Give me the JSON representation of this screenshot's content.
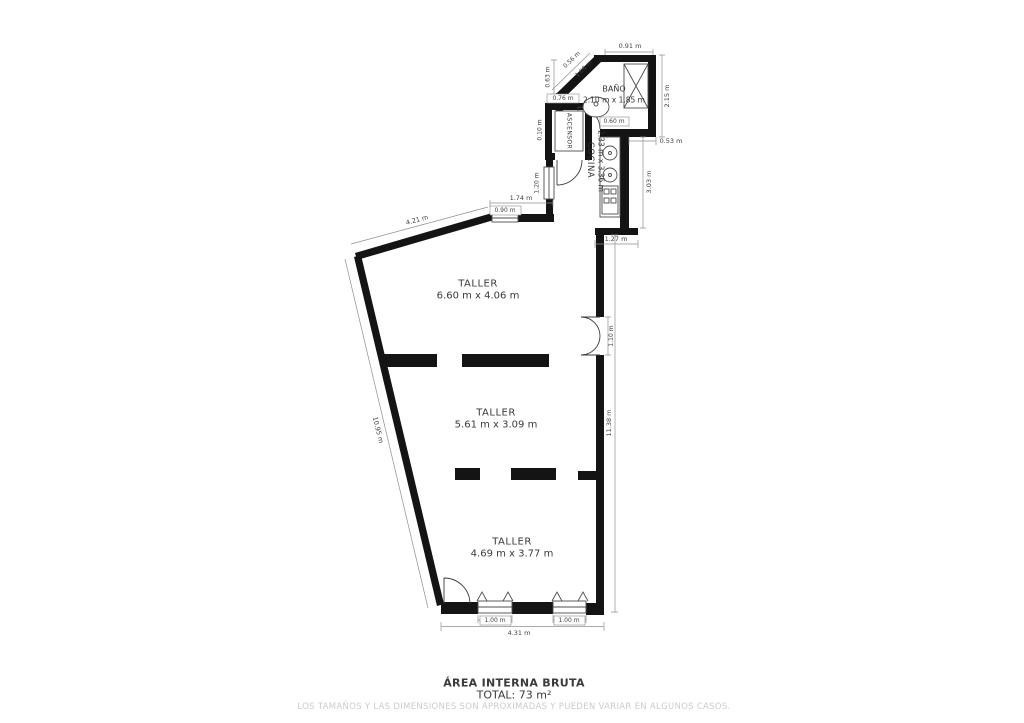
{
  "plan": {
    "rooms": {
      "bano": {
        "name": "BAÑO",
        "size": "2.10 m x 1.85 m"
      },
      "cocina": {
        "name": "COCINA",
        "size": "2.33 m x 3.36 m"
      },
      "ascensor": {
        "name": "ASCENSOR"
      },
      "taller_top": {
        "name": "TALLER",
        "size": "6.60 m x 4.06 m"
      },
      "taller_mid": {
        "name": "TALLER",
        "size": "5.61 m x 3.09 m"
      },
      "taller_bot": {
        "name": "TALLER",
        "size": "4.69 m x 3.77 m"
      }
    },
    "dimensions": {
      "bano_width_top": "0.91 m",
      "chamfer_outer": "0.56 m",
      "chamfer_inner": "1.09 m",
      "bano_left": "0.63 m",
      "bano_right": "2.15 m",
      "bano_door": "0.60 m",
      "bano_offset": "0.53 m",
      "ascensor_width": "0.76 m",
      "wall_gap": "0.10 m",
      "corridor_window": "1.20 m",
      "cocina_right": "3.03 m",
      "cocina_bottom": "1.27 m",
      "top_span": "1.74 m",
      "top_window": "0.90 m",
      "top_wall": "4.21 m",
      "left_wall": "10.95 m",
      "right_wall": "11.38 m",
      "double_door": "1.10 m",
      "window_left": "1.00 m",
      "window_right": "1.00 m",
      "bottom_width": "4.31 m"
    }
  },
  "footer": {
    "title": "ÁREA INTERNA BRUTA",
    "total": "TOTAL: 73 m²",
    "disclaimer": "LOS TAMAÑOS Y LAS DIMENSIONES SON APROXIMADAS Y PUEDEN VARIAR EN ALGUNOS CASOS."
  },
  "colors": {
    "wall": "#141414",
    "dimension_line": "#8f8f8f",
    "text": "#3a3a3a",
    "muted_text": "#cbcbcb",
    "background": "#ffffff"
  }
}
